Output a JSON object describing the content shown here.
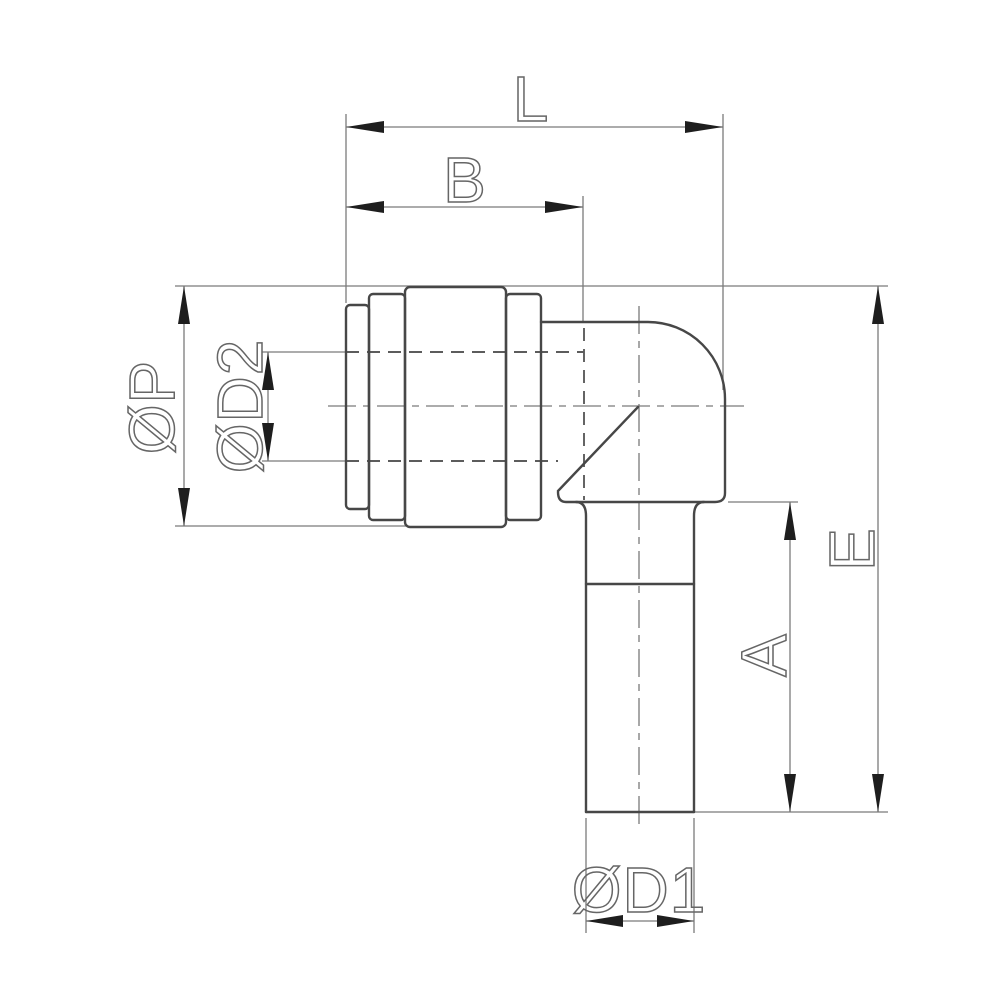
{
  "drawing": {
    "background": "#ffffff",
    "colors": {
      "outline": "#474747",
      "dimension": "#7b7b7b",
      "hidden": "#5c5c5c",
      "centerline": "#7a7a7a",
      "arrow": "#1e1e1e",
      "label": "#666666"
    },
    "labels": {
      "top_length": "L",
      "body_length": "B",
      "outer_diameter": "ØP",
      "bore_diameter": "ØD2",
      "overall_height": "E",
      "stem_length": "A",
      "stem_diameter": "ØD1"
    }
  }
}
